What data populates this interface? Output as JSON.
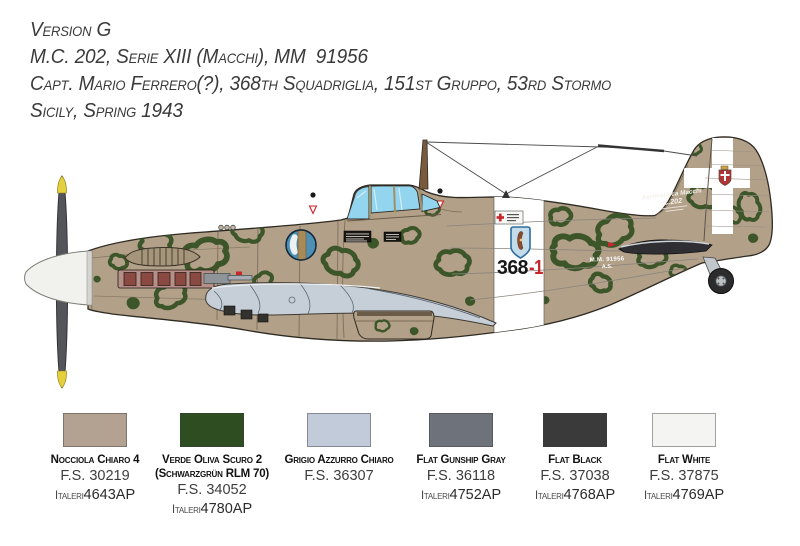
{
  "header": {
    "line1": "Version G",
    "line2": "M.C. 202, Serie XIII (Macchi), MM  91956",
    "line3": "Capt. Mario Ferrero(?), 368th Squadriglia, 151st Gruppo, 53rd Stormo",
    "line4": "Sicily, Spring 1943"
  },
  "aircraft": {
    "fuselage_code": "368",
    "fuselage_code_suffix": "-1",
    "serial_line1": "M.M. 91956",
    "serial_line2": "A.S.",
    "logo_line1": "Aeronautica Macchi",
    "logo_line2": "C.202",
    "colors": {
      "base_tan": "#b2a089",
      "camo_green": "#3c5529",
      "underside_gray": "#c6cfd8",
      "canopy_blue": "#93d4ee",
      "spinner_white": "#f1f1ee",
      "prop_gray": "#54555a",
      "prop_tip_yellow": "#e4cf3c",
      "band_white": "#ffffff",
      "code_red": "#c9252c",
      "exhaust_red": "#8a4a42",
      "emblem_blue": "#4d90b4"
    }
  },
  "palette": [
    {
      "name": "Nocciola Chiaro 4",
      "name2": "",
      "fs": "F.S. 30219",
      "brand": "Italeri",
      "code": "4643AP",
      "hex": "#b3a292"
    },
    {
      "name": "Verde Oliva Scuro 2",
      "name2": "(Schwarzgrün RLM 70)",
      "fs": "F.S. 34052",
      "brand": "Italeri",
      "code": "4780AP",
      "hex": "#2e4d21"
    },
    {
      "name": "Grigio Azzurro Chiaro",
      "name2": "",
      "fs": "F.S. 36307",
      "brand": "",
      "code": "",
      "hex": "#c2cbd9"
    },
    {
      "name": "Flat Gunship Gray",
      "name2": "",
      "fs": "F.S. 36118",
      "brand": "Italeri",
      "code": "4752AP",
      "hex": "#6e727b"
    },
    {
      "name": "Flat Black",
      "name2": "",
      "fs": "F.S. 37038",
      "brand": "Italeri",
      "code": "4768AP",
      "hex": "#3a3a3a"
    },
    {
      "name": "Flat White",
      "name2": "",
      "fs": "F.S. 37875",
      "brand": "Italeri",
      "code": "4769AP",
      "hex": "#f4f4f2"
    }
  ]
}
